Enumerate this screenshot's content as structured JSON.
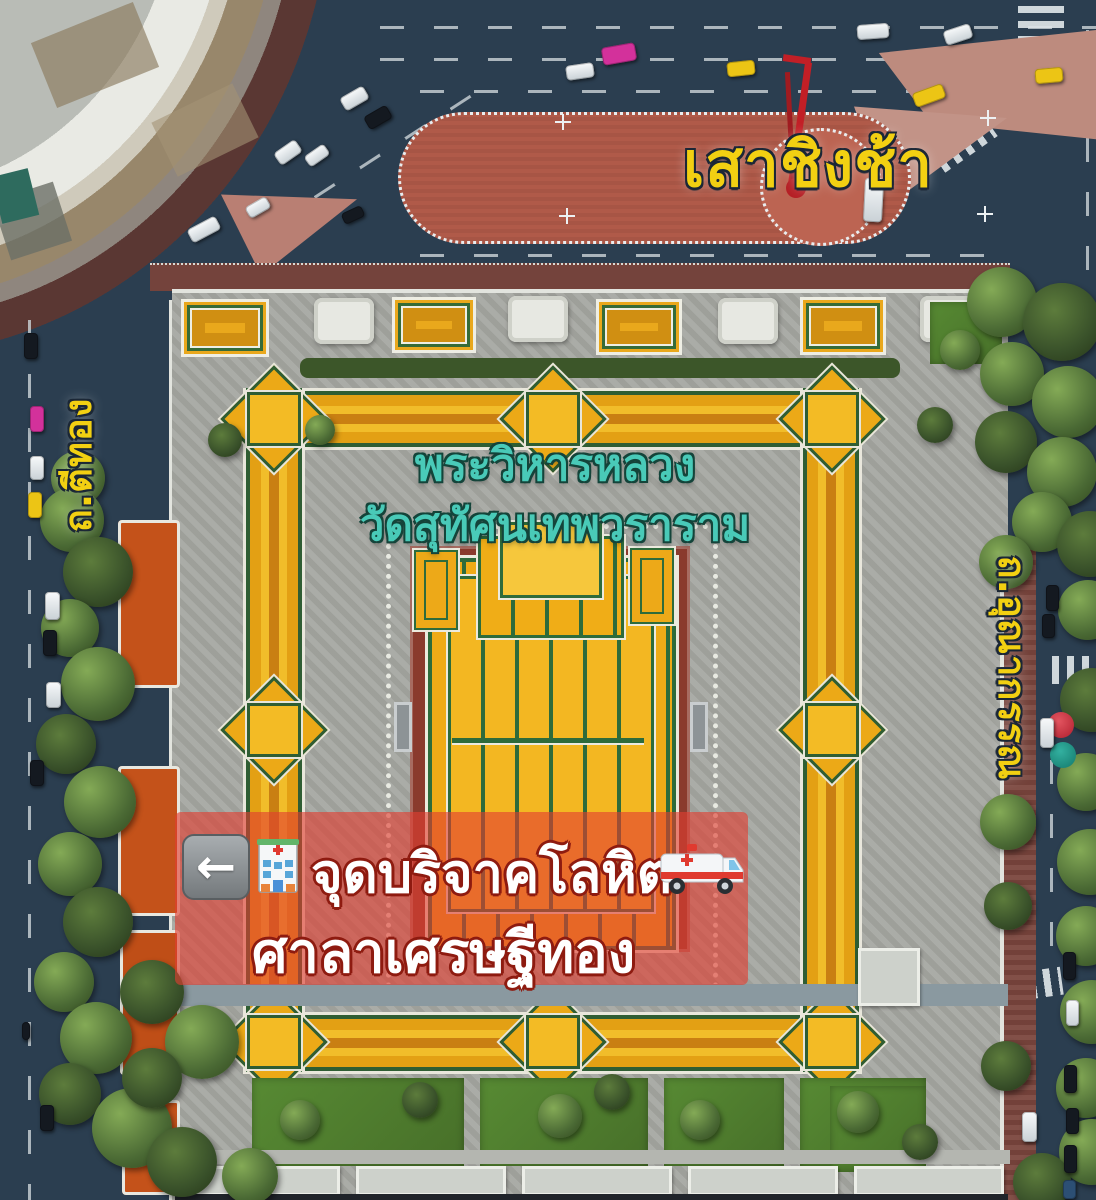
{
  "labels": {
    "landmark_top": "เสาชิงช้า",
    "temple_line1": "พระวิหารหลวง",
    "temple_line2": "วัดสุทัศนเทพวราราม",
    "street_left": "ถ.ตีทอง",
    "street_right": "ถ.อุณากรรณ"
  },
  "banner": {
    "line1": "จุดบริจาคโลหิต",
    "line2": "ศาลาเศรษฐีทอง",
    "arrow_glyph": "←",
    "icons": [
      "left-arrow-icon",
      "hospital-icon",
      "ambulance-icon"
    ]
  },
  "colors": {
    "road": "#2b3e50",
    "plaza_brick": "#b05a49",
    "swing_red": "#c21f26",
    "temple_roof_gold": "#eea91a",
    "roof_green": "#2e6b3b",
    "courtyard_red": "#8a3a2d",
    "west_roof_orange": "#c4521a",
    "banner_red": "rgba(226,62,48,0.62)",
    "label_yellow": "#f2d012",
    "label_teal": "#49cab8",
    "pavement_gray": "#a6a8a2"
  }
}
